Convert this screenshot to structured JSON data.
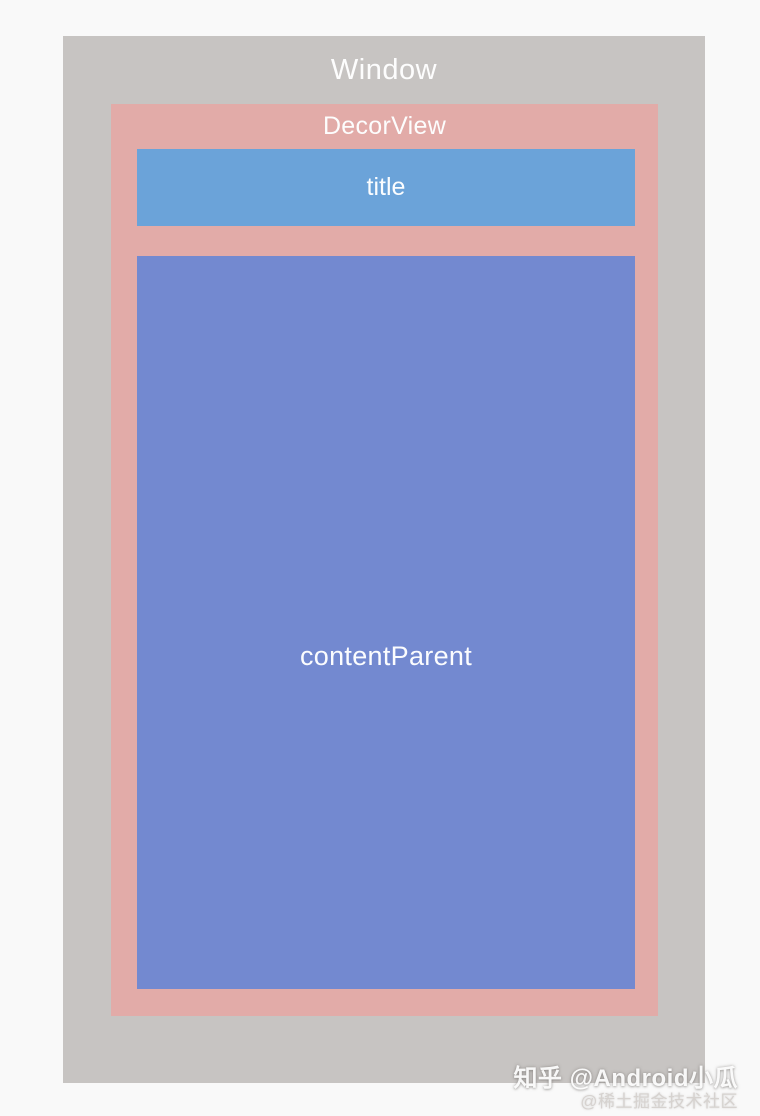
{
  "diagram": {
    "window_label": "Window",
    "decorview_label": "DecorView",
    "title_label": "title",
    "content_parent_label": "contentParent"
  },
  "colors": {
    "page_background": "#f9f9f9",
    "window": "#c7c4c2",
    "decorview": "#e2aba8",
    "title": "#6ba3d9",
    "content_parent": "#7389d0",
    "label_text": "#fdfdfd"
  },
  "watermark": {
    "line1": "知乎 @Android小瓜",
    "line2": "@稀土掘金技术社区"
  }
}
